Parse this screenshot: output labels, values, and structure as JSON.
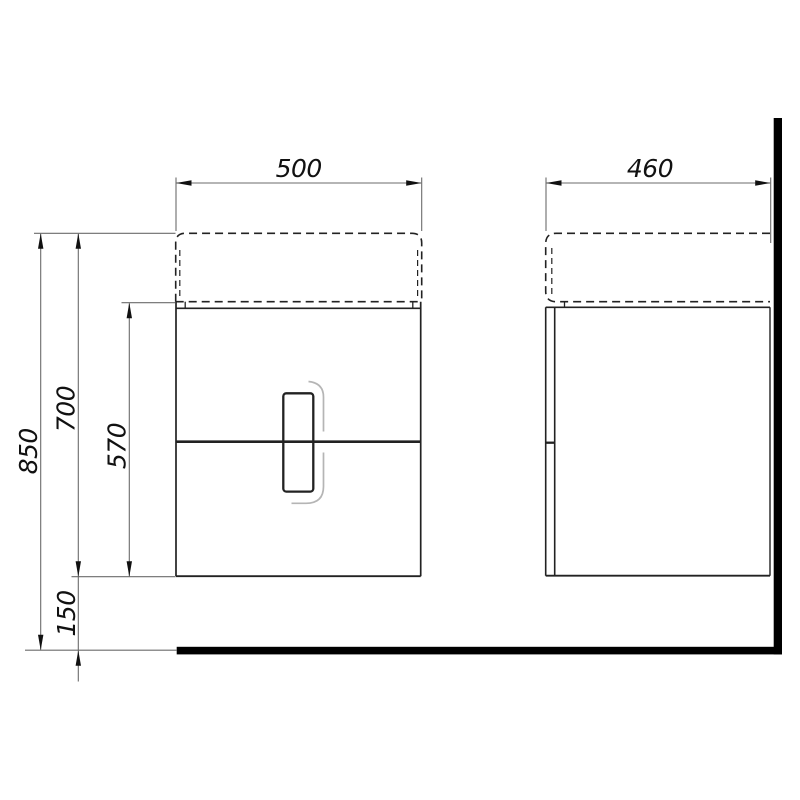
{
  "drawing": {
    "type": "technical-drawing",
    "subject": "wall-hung vanity cabinet with washbasin, front and side views",
    "units_shown": "none (millimetre values implied)",
    "front_view": {
      "width_label": "500",
      "total_height_label": "850",
      "unit_height_label": "700",
      "cabinet_body_height_label": "570",
      "floor_clearance_label": "150"
    },
    "side_view": {
      "depth_label": "460"
    },
    "colors": {
      "background": "#ffffff",
      "object_lines": "#222222",
      "dimension_lines": "#6b6b6b",
      "arrowheads": "#111111",
      "wall_and_floor_fill": "#000000",
      "handle_shadow": "#b5b5b5",
      "text": "#111111"
    }
  }
}
